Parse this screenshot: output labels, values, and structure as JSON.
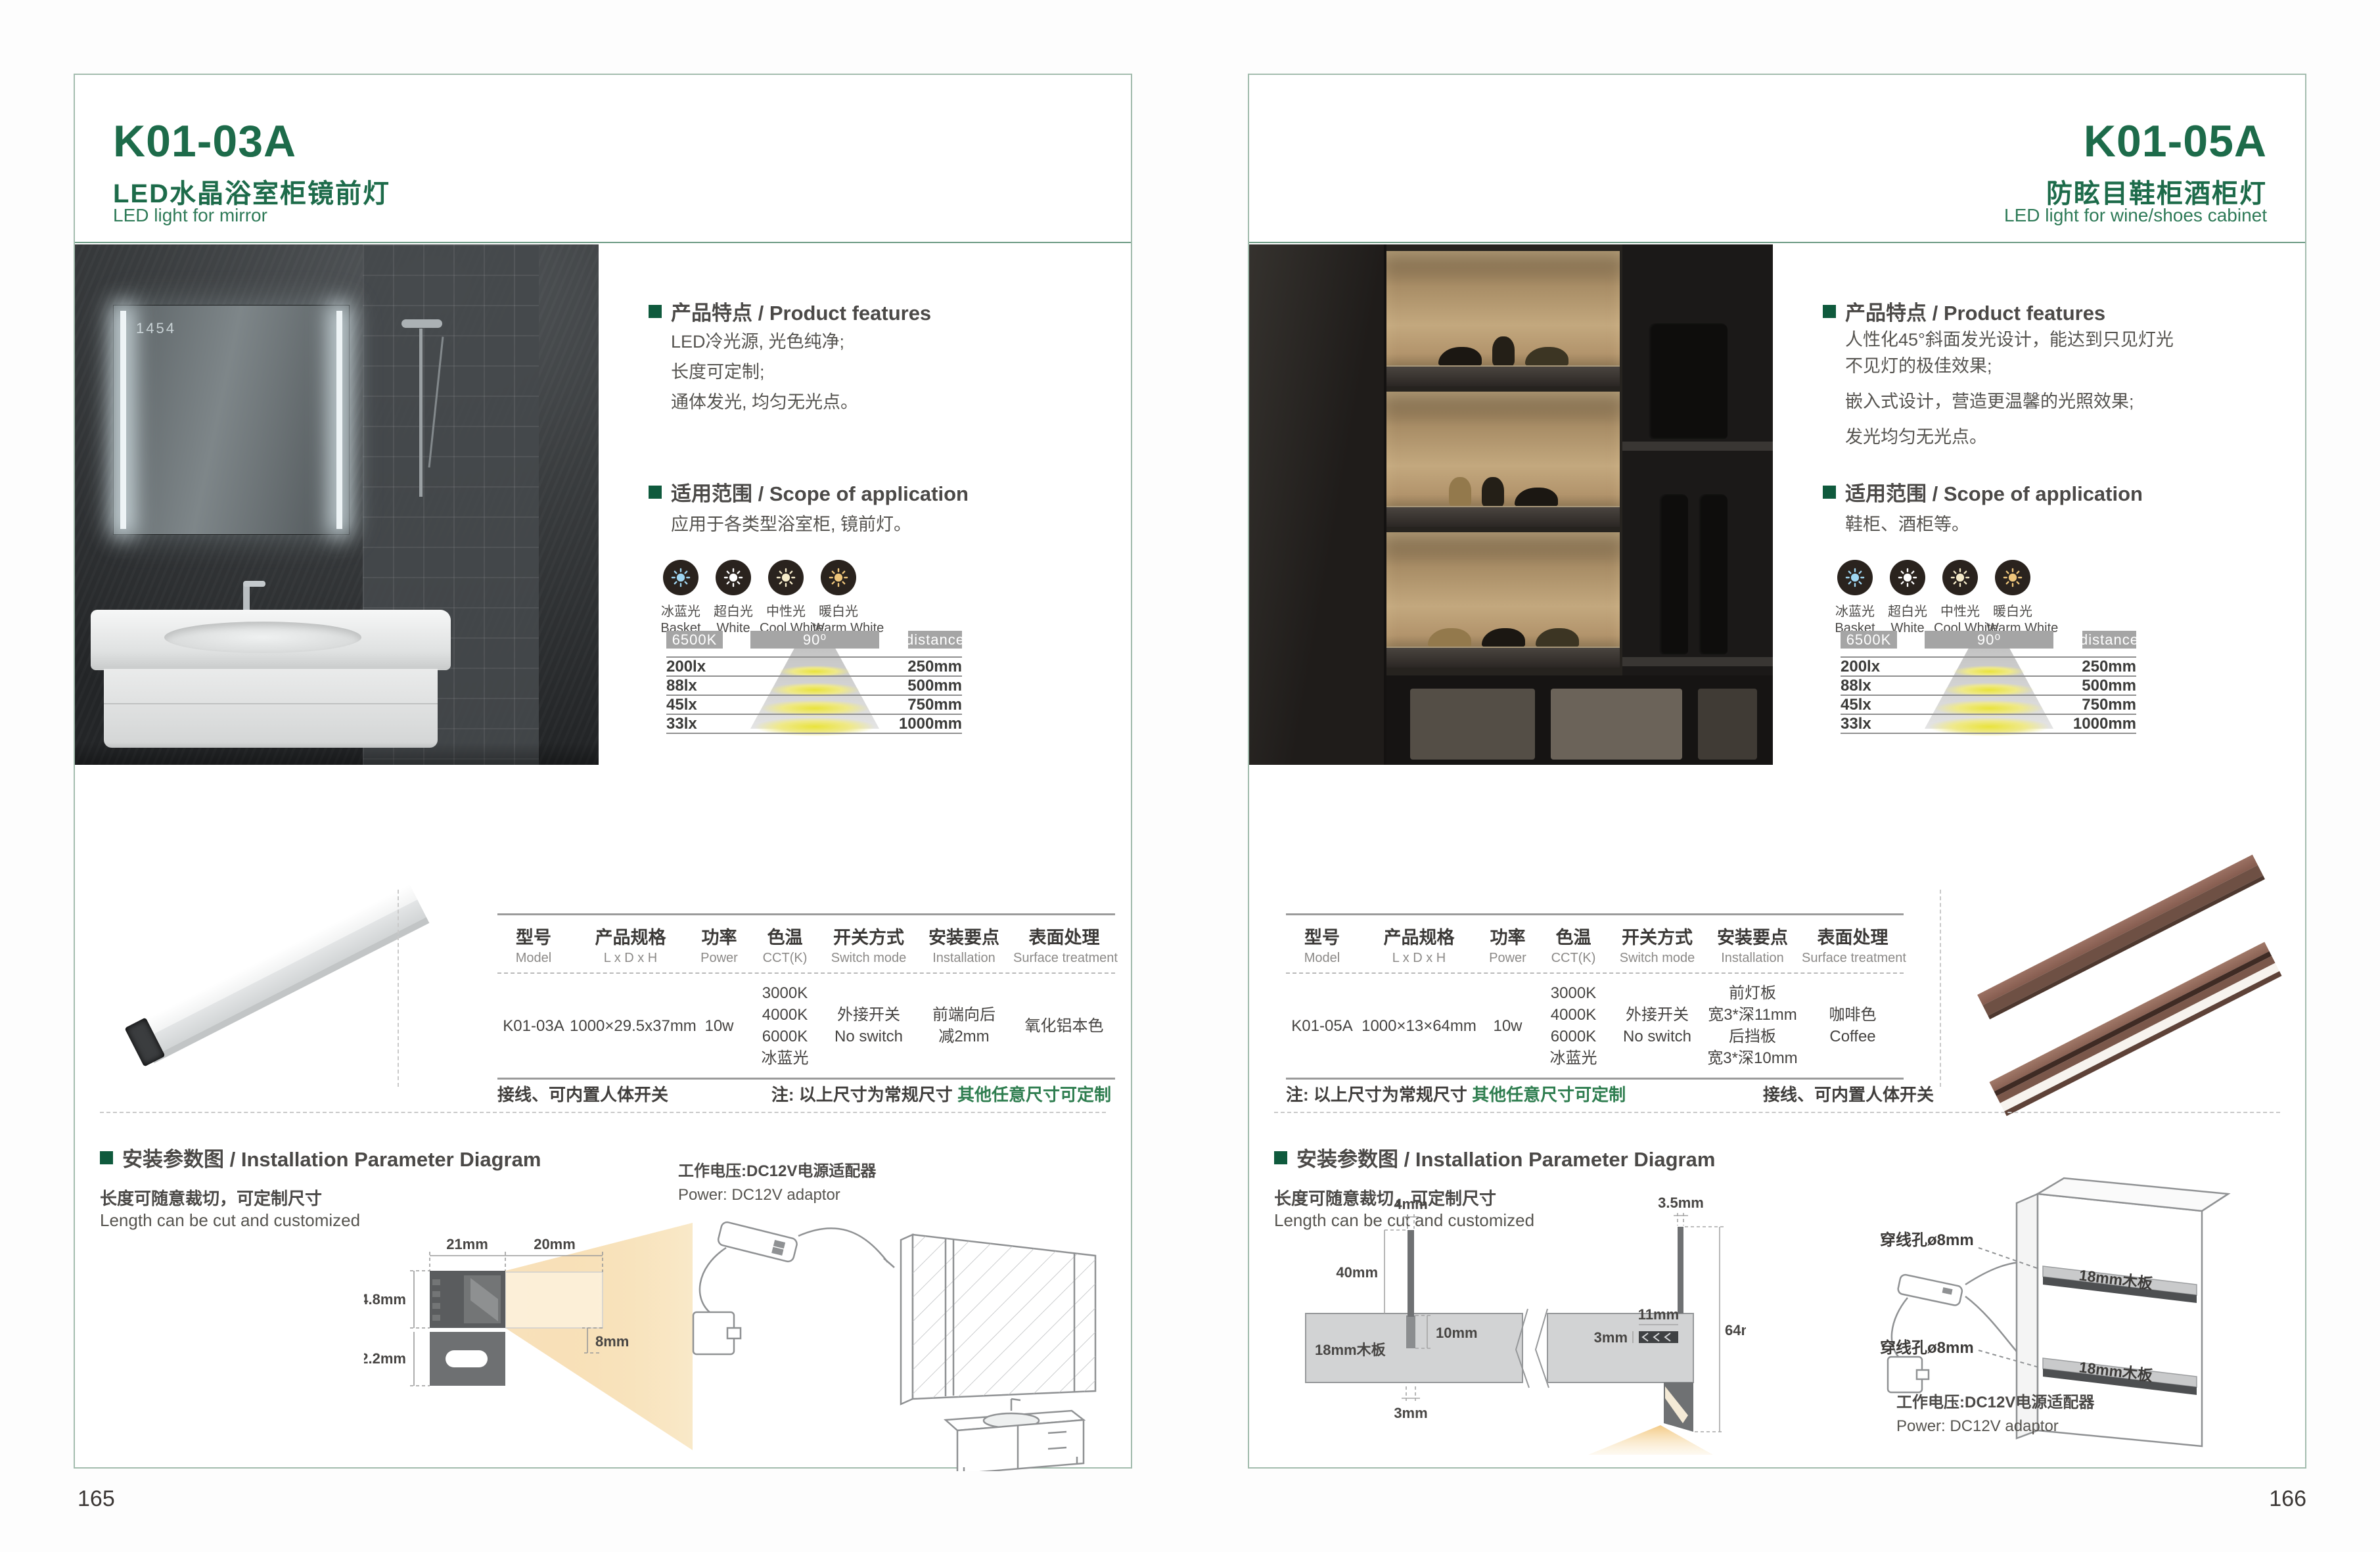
{
  "shared": {
    "colors": {
      "accent_green": "#1d6b4a",
      "note_green": "#2e7d4f",
      "bar_gray": "#a5a5a5"
    },
    "light_modes": [
      {
        "cn": "冰蓝光",
        "en": "Basket",
        "color": "#9fd6f2"
      },
      {
        "cn": "超白光",
        "en": "White",
        "color": "#ffffff"
      },
      {
        "cn": "中性光",
        "en": "Cool White",
        "color": "#f6ecca"
      },
      {
        "cn": "暖白光",
        "en": "Warm White",
        "color": "#efc67b"
      }
    ],
    "beam": {
      "cct": "6500K",
      "angle": "90⁰",
      "distance": "distance",
      "rows": [
        {
          "lux": "200lx",
          "dist": "250mm"
        },
        {
          "lux": "88lx",
          "dist": "500mm"
        },
        {
          "lux": "45lx",
          "dist": "750mm"
        },
        {
          "lux": "33lx",
          "dist": "1000mm"
        }
      ]
    },
    "table_headers": [
      {
        "cn": "型号",
        "en": "Model"
      },
      {
        "cn": "产品规格",
        "en": "L x D x H"
      },
      {
        "cn": "功率",
        "en": "Power"
      },
      {
        "cn": "色温",
        "en": "CCT(K)"
      },
      {
        "cn": "开关方式",
        "en": "Switch mode"
      },
      {
        "cn": "安装要点",
        "en": "Installation"
      },
      {
        "cn": "表面处理",
        "en": "Surface treatment"
      }
    ]
  },
  "page_left": {
    "page_no": "165",
    "model": "K01-03A",
    "title_cn": "LED水晶浴室柜镜前灯",
    "title_en": "LED light for mirror",
    "features_heading": "产品特点 / Product features",
    "features": [
      "LED冷光源, 光色纯净;",
      "长度可定制;",
      "通体发光, 均匀无光点。"
    ],
    "scope_heading": "适用范围 / Scope of application",
    "scope_text": "应用于各类型浴室柜, 镜前灯。",
    "photo": {
      "mirror_clock": "1454"
    },
    "table_row": [
      "K01-03A",
      "1000×29.5x37mm",
      "10w",
      "3000K\n4000K\n6000K\n冰蓝光",
      "外接开关\nNo switch",
      "前端向后\n减2mm",
      "氧化铝本色"
    ],
    "note_wiring": "接线、可内置人体开关",
    "note_prefix": "注: 以上尺寸为常规尺寸 ",
    "note_custom": "其他任意尺寸可定制",
    "install_heading": "安装参数图 / Installation Parameter Diagram",
    "length_cn": "长度可随意裁切，可定制尺寸",
    "length_en": "Length can be cut and customized",
    "power_cn": "工作电压:DC12V电源适配器",
    "power_en": "Power: DC12V adaptor",
    "diagram": {
      "d21": "21mm",
      "d20": "20mm",
      "d148": "14.8mm",
      "d122": "12.2mm",
      "d8": "8mm"
    }
  },
  "page_right": {
    "page_no": "166",
    "model": "K01-05A",
    "title_cn": "防眩目鞋柜酒柜灯",
    "title_en": "LED light for wine/shoes cabinet",
    "features_heading": "产品特点 / Product features",
    "features": [
      "人性化45°斜面发光设计，能达到只见灯光\n不见灯的极佳效果;",
      "嵌入式设计，营造更温馨的光照效果;",
      "发光均匀无光点。"
    ],
    "scope_heading": "适用范围 / Scope of application",
    "scope_text": "鞋柜、酒柜等。",
    "table_row": [
      "K01-05A",
      "1000×13×64mm",
      "10w",
      "3000K\n4000K\n6000K\n冰蓝光",
      "外接开关\nNo switch",
      "前灯板\n宽3*深11mm\n后挡板\n宽3*深10mm",
      "咖啡色\nCoffee"
    ],
    "note_prefix": "注: 以上尺寸为常规尺寸 ",
    "note_custom": "其他任意尺寸可定制",
    "note_wiring": "接线、可内置人体开关",
    "install_heading": "安装参数图 / Installation Parameter Diagram",
    "length_cn": "长度可随意裁切，可定制尺寸",
    "length_en": "Length can be cut and customized",
    "power_cn": "工作电压:DC12V电源适配器",
    "power_en": "Power: DC12V adaptor",
    "diagram": {
      "d4": "4mm",
      "d40": "40mm",
      "d3a": "3mm",
      "d10": "10mm",
      "board": "18mm木板",
      "d35": "3.5mm",
      "d11": "11mm",
      "d3b": "3mm",
      "d64": "64mm"
    },
    "cabinet": {
      "hole1": "穿线孔ø8mm",
      "hole2": "穿线孔ø8mm",
      "board1": "18mm木板",
      "board2": "18mm木板"
    }
  }
}
